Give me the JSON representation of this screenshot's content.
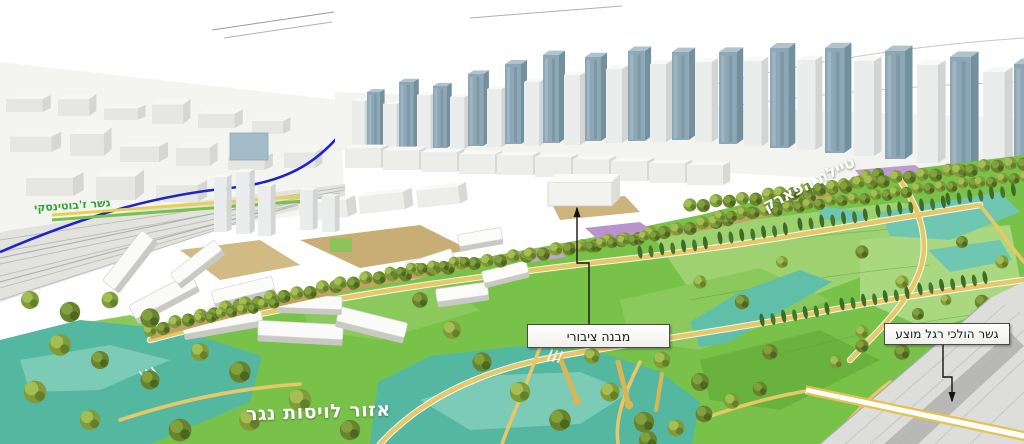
{
  "scene": {
    "description": "aerial 3d urban masterplan rendering with park and city skyline"
  },
  "annotations": {
    "public_building_label": "מבנה ציבורי",
    "pedestrian_bridge_label": "גשר הולכי רגל מוצע",
    "runoff_area_label": "אזור לויסות נגר",
    "park_promenade_label": "טיילת הפארק",
    "jabotinsky_bridge_label": "גשר ז'בוטינסקי"
  },
  "colors": {
    "park_green": "#79c24a",
    "lawn_light": "#9ed271",
    "lawn_dark": "#59a637",
    "water_teal": "#54b8a0",
    "water_teal_light": "#7ccbb6",
    "path_yellow": "#e7c768",
    "tree_olive": "#7f9c39",
    "cypress_green": "#3e6b26",
    "glass_tower_blue": "#8da7b6",
    "plaza_purple": "#b794cb",
    "light_rail_blue": "#2222cc",
    "road_green_line": "#76c24a",
    "jabotinsky_text_green": "#2da52f",
    "road_gray": "#dddddc"
  }
}
